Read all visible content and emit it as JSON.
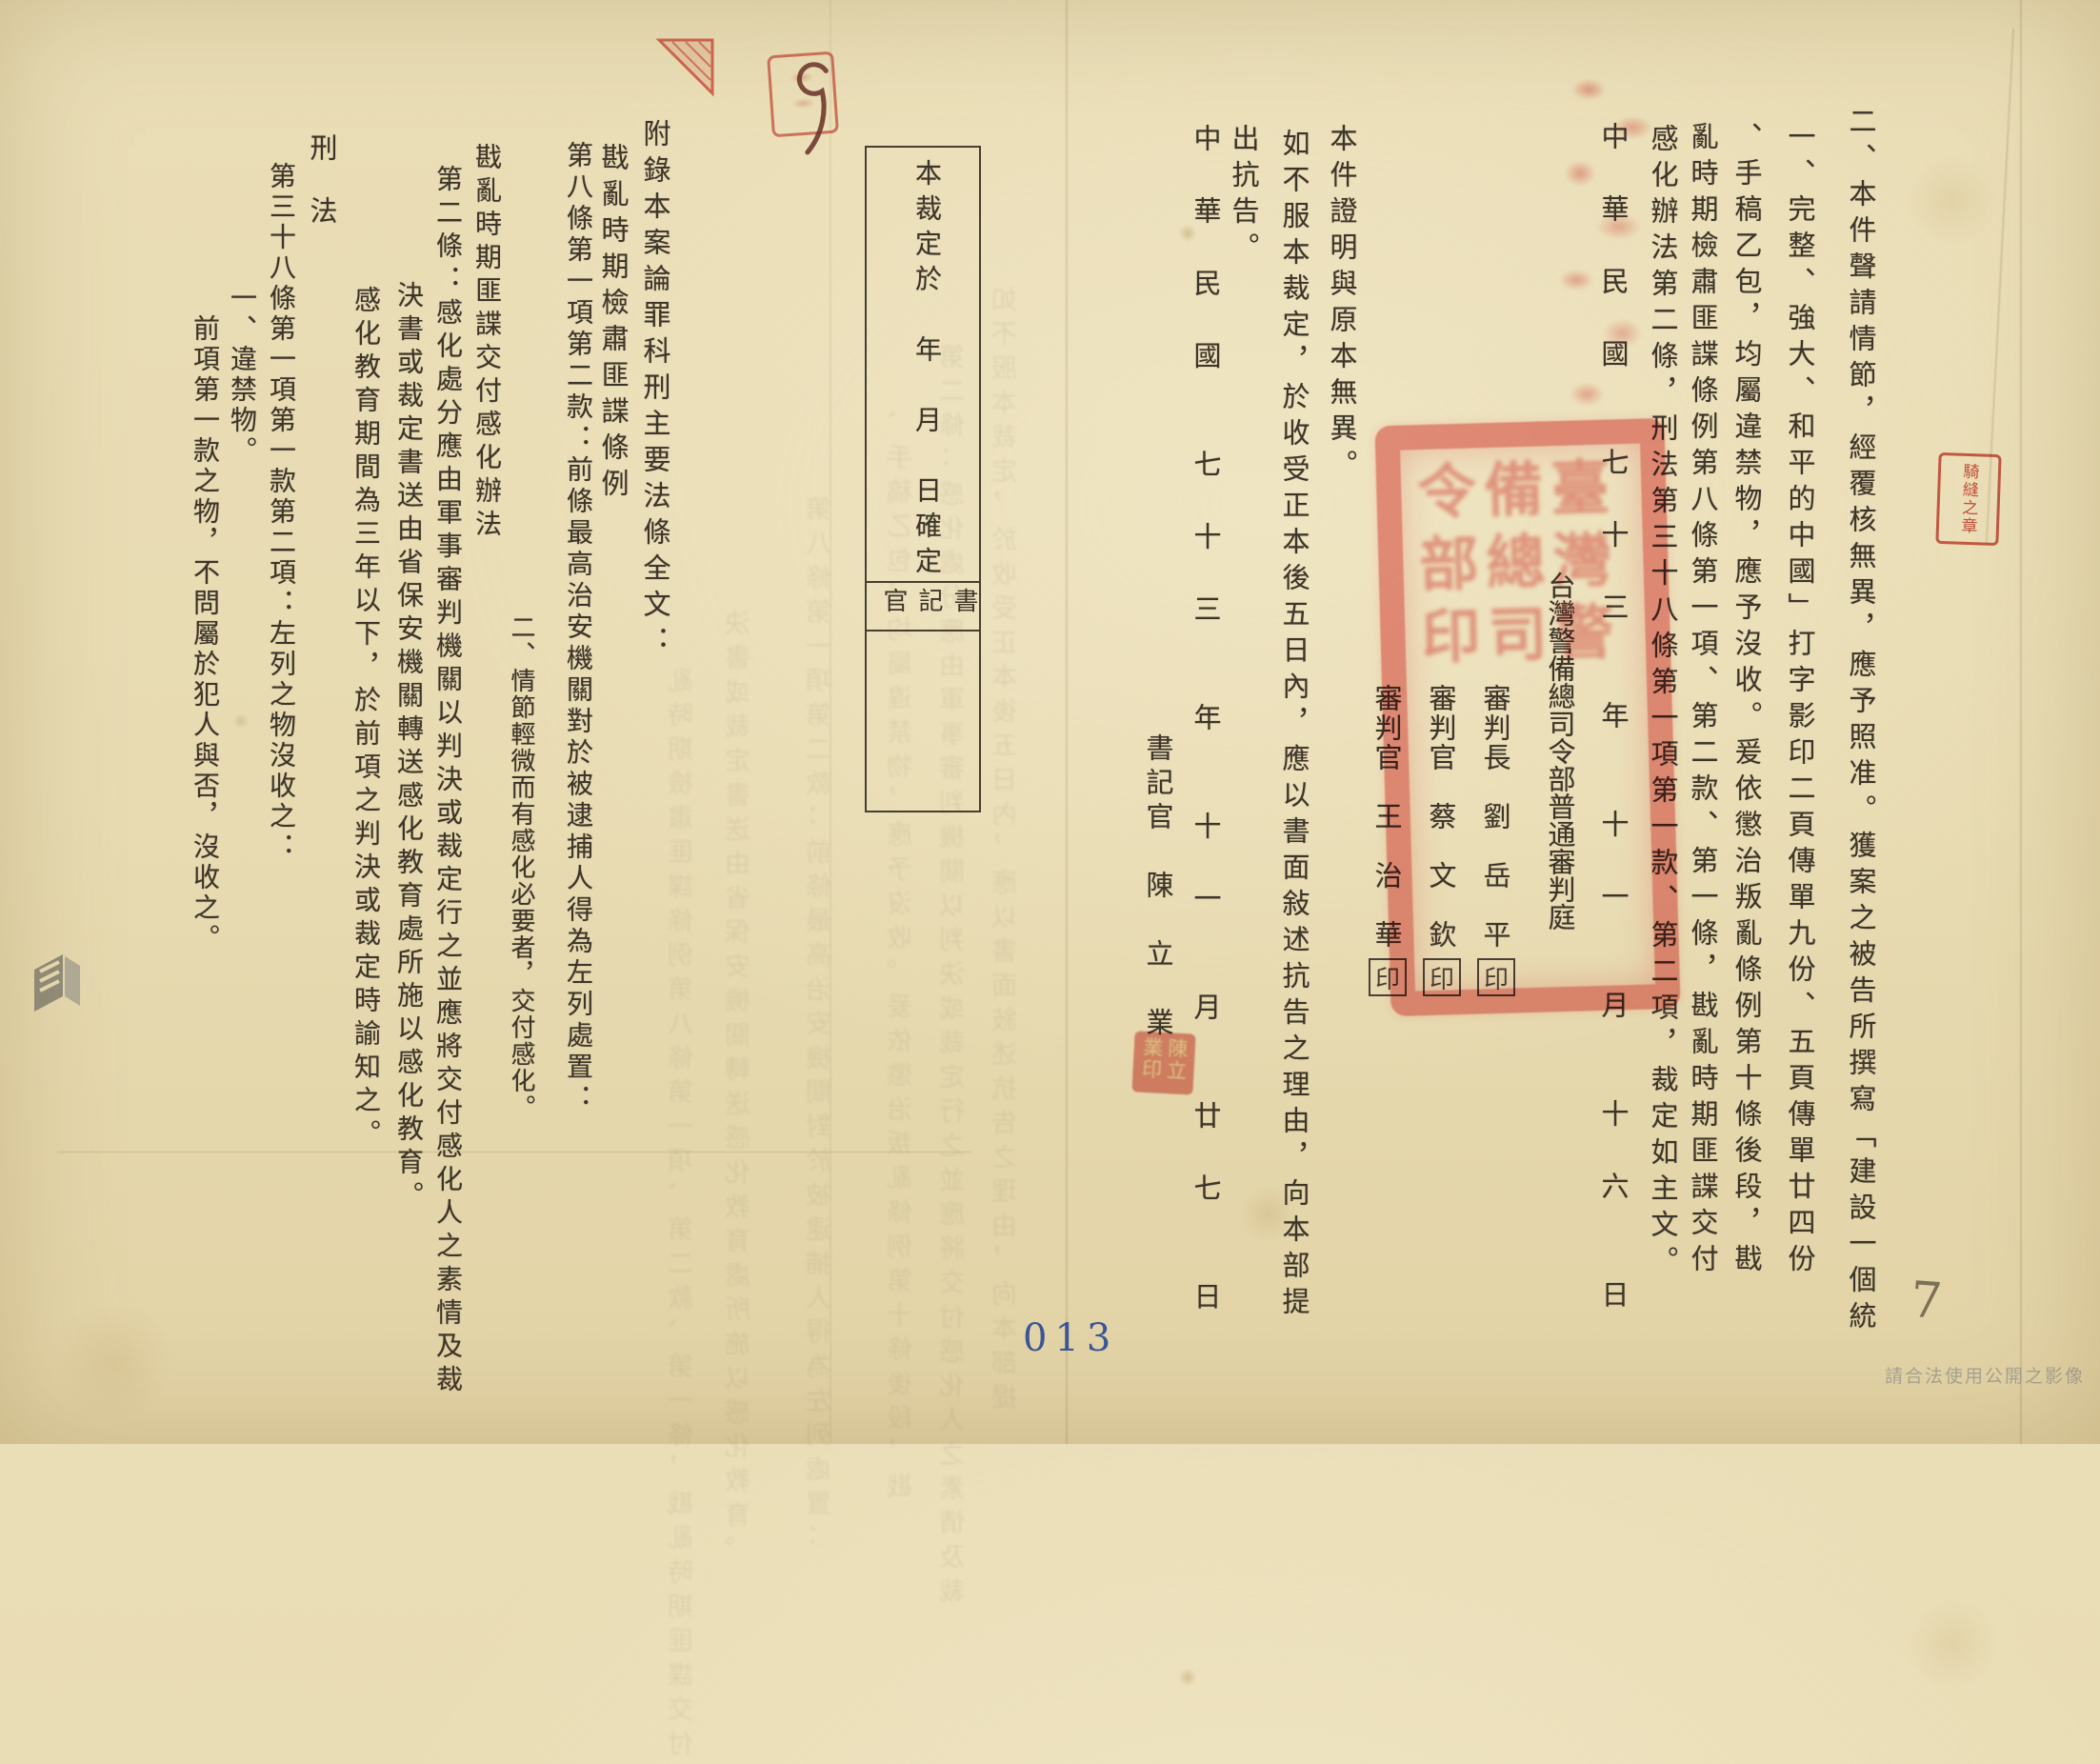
{
  "cols": {
    "a": "二、本件聲請情節，經覆核無異，應予照准。獲案之被告所撰寫「建設一個統",
    "b": "一、完整、強大、和平的中國」打字影印二頁傳單九份、五頁傳單廿四份",
    "c": "、手稿乙包，均屬違禁物，應予沒收。爰依懲治叛亂條例第十條後段，戡",
    "d": "亂時期檢肅匪諜條例第八條第一項、第二款、第一條，戡亂時期匪諜交付",
    "e": "感化辦法第二條，刑法第三十八條第一項第一款、第二項，裁定如主文。",
    "date1": "中　華　民　國　　七　十　三　　年　　十　一　　月　　十　六　　日",
    "court": "台灣警備總司令部普通審判庭",
    "judge1": "審判長　劉　岳　平",
    "judge2": "審判官　蔡　文　欽",
    "judge3": "審判官　王　治　華",
    "certify": "本件證明與原本無異。",
    "appeal1": "如不服本裁定，於收受正本後五日內，應以書面敍述抗告之理由，向本部提",
    "appeal2": "出抗告。",
    "date2": "中　華　民　國　　七　十　三　　年　　十　一　　月　　廿　七　　日",
    "clerk": "書記官　陳　立　業",
    "box_line": "本裁定於　年　月　日確定",
    "box_clerk": "書記官",
    "appendix_title": "附錄本案論罪科刑主要法條全文：",
    "law1_name": "戡亂時期檢肅匪諜條例",
    "law1_art": "第八條第一項第二款：前條最高治安機關對於被逮捕人得為左列處置：",
    "law1_item": "二、情節輕微而有感化必要者，交付感化。",
    "law2_name": "戡亂時期匪諜交付感化辦法",
    "law2_art": "第二條：感化處分應由軍事審判機關以判決或裁定行之並應將交付感化人之素情及裁",
    "law2_cont": "決書或裁定書送由省保安機關轉送感化教育處所施以感化教育。",
    "law2_par2": "感化教育期間為三年以下，於前項之判決或裁定時諭知之。",
    "law3_name": "刑　法",
    "law3_art": "第三十八條第一項第一款第二項：左列之物沒收之：",
    "law3_item": "一、違禁物。",
    "law3_par2": "前項第一款之物，不問屬於犯人與否，沒收之。"
  },
  "stamps": {
    "official_seal": "臺灣警備總司令部印",
    "seal_mark": "印",
    "clerk_seal": "陳立業印",
    "seam_seal": "騎縫之章",
    "page_stamp": "013",
    "handwritten_top": "9",
    "handwritten_bottom": "7",
    "watermark": "請合法使用公開之影像"
  }
}
